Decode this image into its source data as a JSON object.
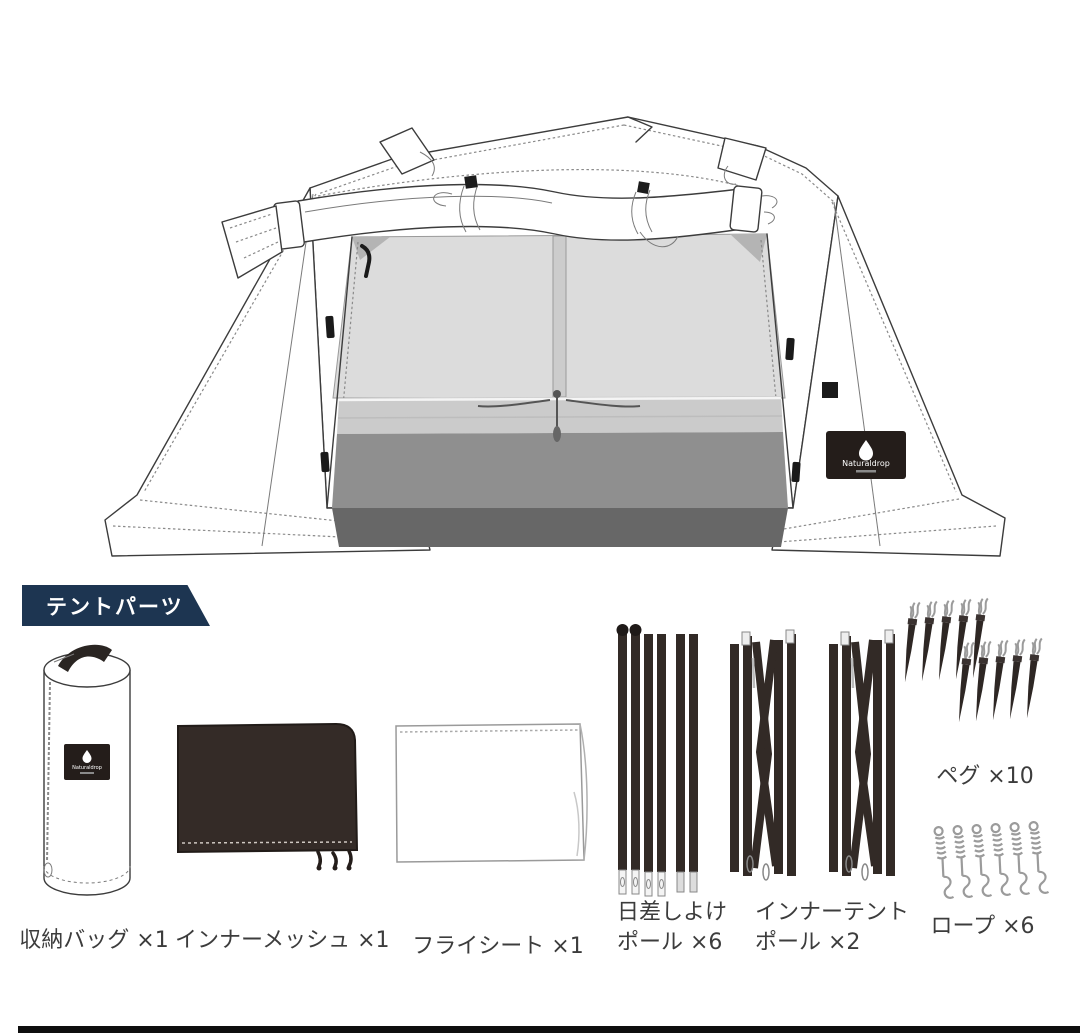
{
  "banner": {
    "label": "テントパーツ"
  },
  "brand": {
    "name": "Naturaldrop"
  },
  "tent": {
    "description": "tent-line-drawing-front-view"
  },
  "parts": {
    "storage_bag": {
      "label": "収納バッグ ×1"
    },
    "inner_mesh": {
      "label": "インナーメッシュ ×1"
    },
    "fly_sheet": {
      "label": "フライシート ×1"
    },
    "sunshade_poles": {
      "label_line1": "日差しよけ",
      "label_line2": "ポール ×6"
    },
    "inner_tent_poles": {
      "label_line1": "インナーテント",
      "label_line2": "ポール ×2"
    },
    "pegs": {
      "label": "ペグ ×10"
    },
    "ropes": {
      "label": "ロープ ×6"
    }
  },
  "colors": {
    "banner_bg": "#1d3551",
    "banner_text": "#ffffff",
    "label_text": "#3c3c3c",
    "dark_fabric": "#342b27",
    "mesh_gray": "#dcdcdc",
    "mesh_band": "#c9c9c9",
    "floor_gray": "#8f8f8f",
    "floor_dark": "#676767",
    "line_art": "#3c3c3c",
    "rope_gray": "#9b9b9b"
  }
}
